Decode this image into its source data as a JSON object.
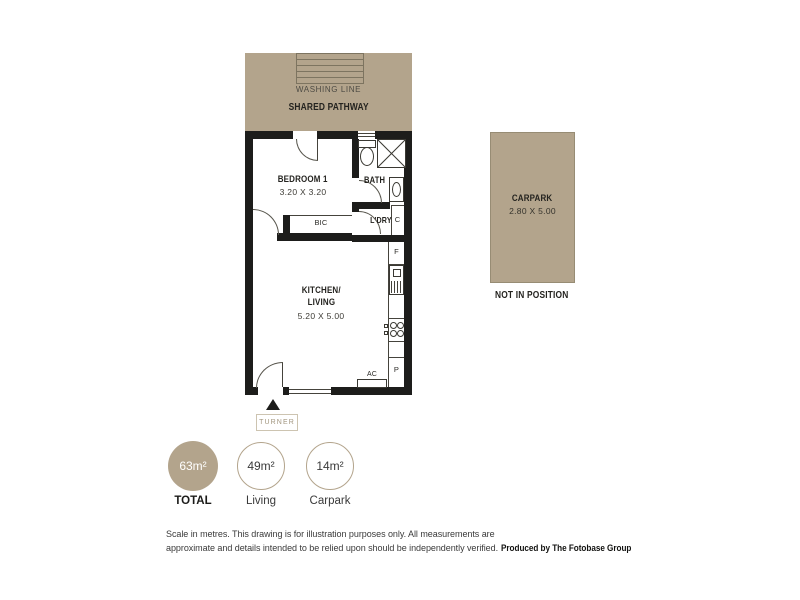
{
  "pathway": {
    "washing_line_label": "WASHING LINE",
    "shared_pathway_label": "SHARED PATHWAY"
  },
  "rooms": {
    "bedroom": {
      "name": "BEDROOM 1",
      "dims": "3.20 X 3.20"
    },
    "bath": {
      "name": "BATH"
    },
    "laundry": {
      "name": "L'DRY"
    },
    "kitchen_living": {
      "name_line1": "KITCHEN/",
      "name_line2": "LIVING",
      "dims": "5.20 X 5.00"
    }
  },
  "fixtures": {
    "bic": "BIC",
    "cupboard": "C",
    "fridge": "F",
    "pantry": "P",
    "ac": "AC"
  },
  "entry": {
    "label": "TURNER"
  },
  "carpark": {
    "name": "CARPARK",
    "dims": "2.80 X 5.00",
    "note": "NOT IN POSITION"
  },
  "areas": [
    {
      "value": "63m²",
      "label": "TOTAL"
    },
    {
      "value": "49m²",
      "label": "Living"
    },
    {
      "value": "14m²",
      "label": "Carpark"
    }
  ],
  "disclaimer": {
    "line1": "Scale in metres. This drawing is for illustration purposes only. All measurements are",
    "line2": "approximate and details intended to be relied upon should be independently verified.",
    "producer": "Produced by The Fotobase Group"
  },
  "colors": {
    "tan": "#b3a48c",
    "wall": "#1d1d1b"
  }
}
